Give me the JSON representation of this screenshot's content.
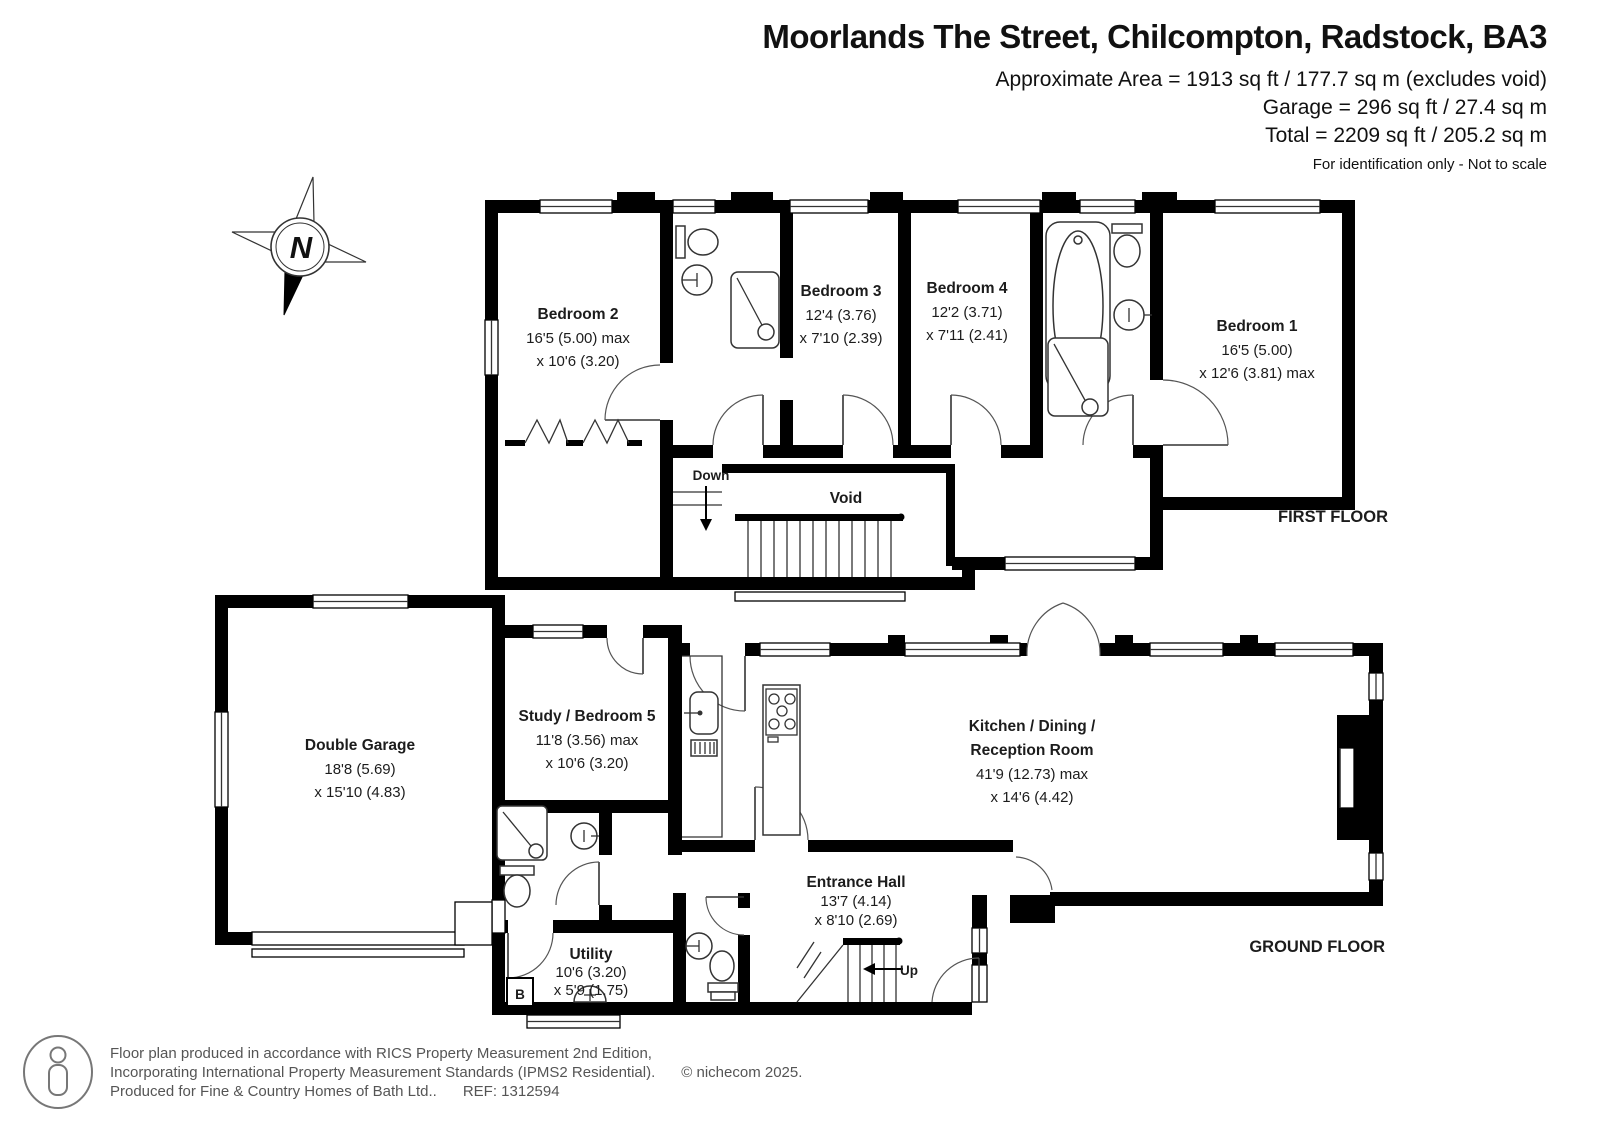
{
  "header": {
    "title": "Moorlands The Street, Chilcompton, Radstock, BA3",
    "area_line1": "Approximate Area = 1913 sq ft / 177.7 sq m (excludes void)",
    "area_line2": "Garage = 296 sq ft / 27.4 sq m",
    "area_line3": "Total = 2209 sq ft / 205.2 sq m",
    "disclaimer": "For identification only - Not to scale"
  },
  "compass": {
    "north_label": "N"
  },
  "first_floor": {
    "floor_label": "FIRST FLOOR",
    "void_label": "Void",
    "stairs_label": "Down",
    "rooms": {
      "bedroom2": {
        "name": "Bedroom 2",
        "dim1": "16'5 (5.00) max",
        "dim2": "x 10'6 (3.20)"
      },
      "bedroom3": {
        "name": "Bedroom 3",
        "dim1": "12'4 (3.76)",
        "dim2": "x 7'10 (2.39)"
      },
      "bedroom4": {
        "name": "Bedroom 4",
        "dim1": "12'2 (3.71)",
        "dim2": "x 7'11 (2.41)"
      },
      "bedroom1": {
        "name": "Bedroom 1",
        "dim1": "16'5 (5.00)",
        "dim2": "x 12'6 (3.81) max"
      }
    }
  },
  "ground_floor": {
    "floor_label": "GROUND FLOOR",
    "stairs_label": "Up",
    "boiler_label": "B",
    "rooms": {
      "garage": {
        "name": "Double Garage",
        "dim1": "18'8 (5.69)",
        "dim2": "x 15'10 (4.83)"
      },
      "study": {
        "name": "Study / Bedroom 5",
        "dim1": "11'8 (3.56) max",
        "dim2": "x 10'6 (3.20)"
      },
      "kitchen": {
        "name_line1": "Kitchen / Dining /",
        "name_line2": "Reception Room",
        "dim1": "41'9 (12.73) max",
        "dim2": "x 14'6 (4.42)"
      },
      "hall": {
        "name": "Entrance Hall",
        "dim1": "13'7 (4.14)",
        "dim2": "x 8'10 (2.69)"
      },
      "utility": {
        "name": "Utility",
        "dim1": "10'6 (3.20)",
        "dim2": "x 5'9 (1.75)"
      }
    }
  },
  "footer": {
    "line1": "Floor plan produced in accordance with RICS Property Measurement 2nd Edition,",
    "line2": "Incorporating International Property Measurement Standards (IPMS2 Residential).",
    "line3": "Produced for Fine & Country Homes of Bath Ltd..",
    "ref": "REF: 1312594",
    "copyright": "© nichecom 2025."
  },
  "colors": {
    "wall": "#000000",
    "background": "#ffffff",
    "text": "#222222",
    "footer_text": "#555555"
  }
}
